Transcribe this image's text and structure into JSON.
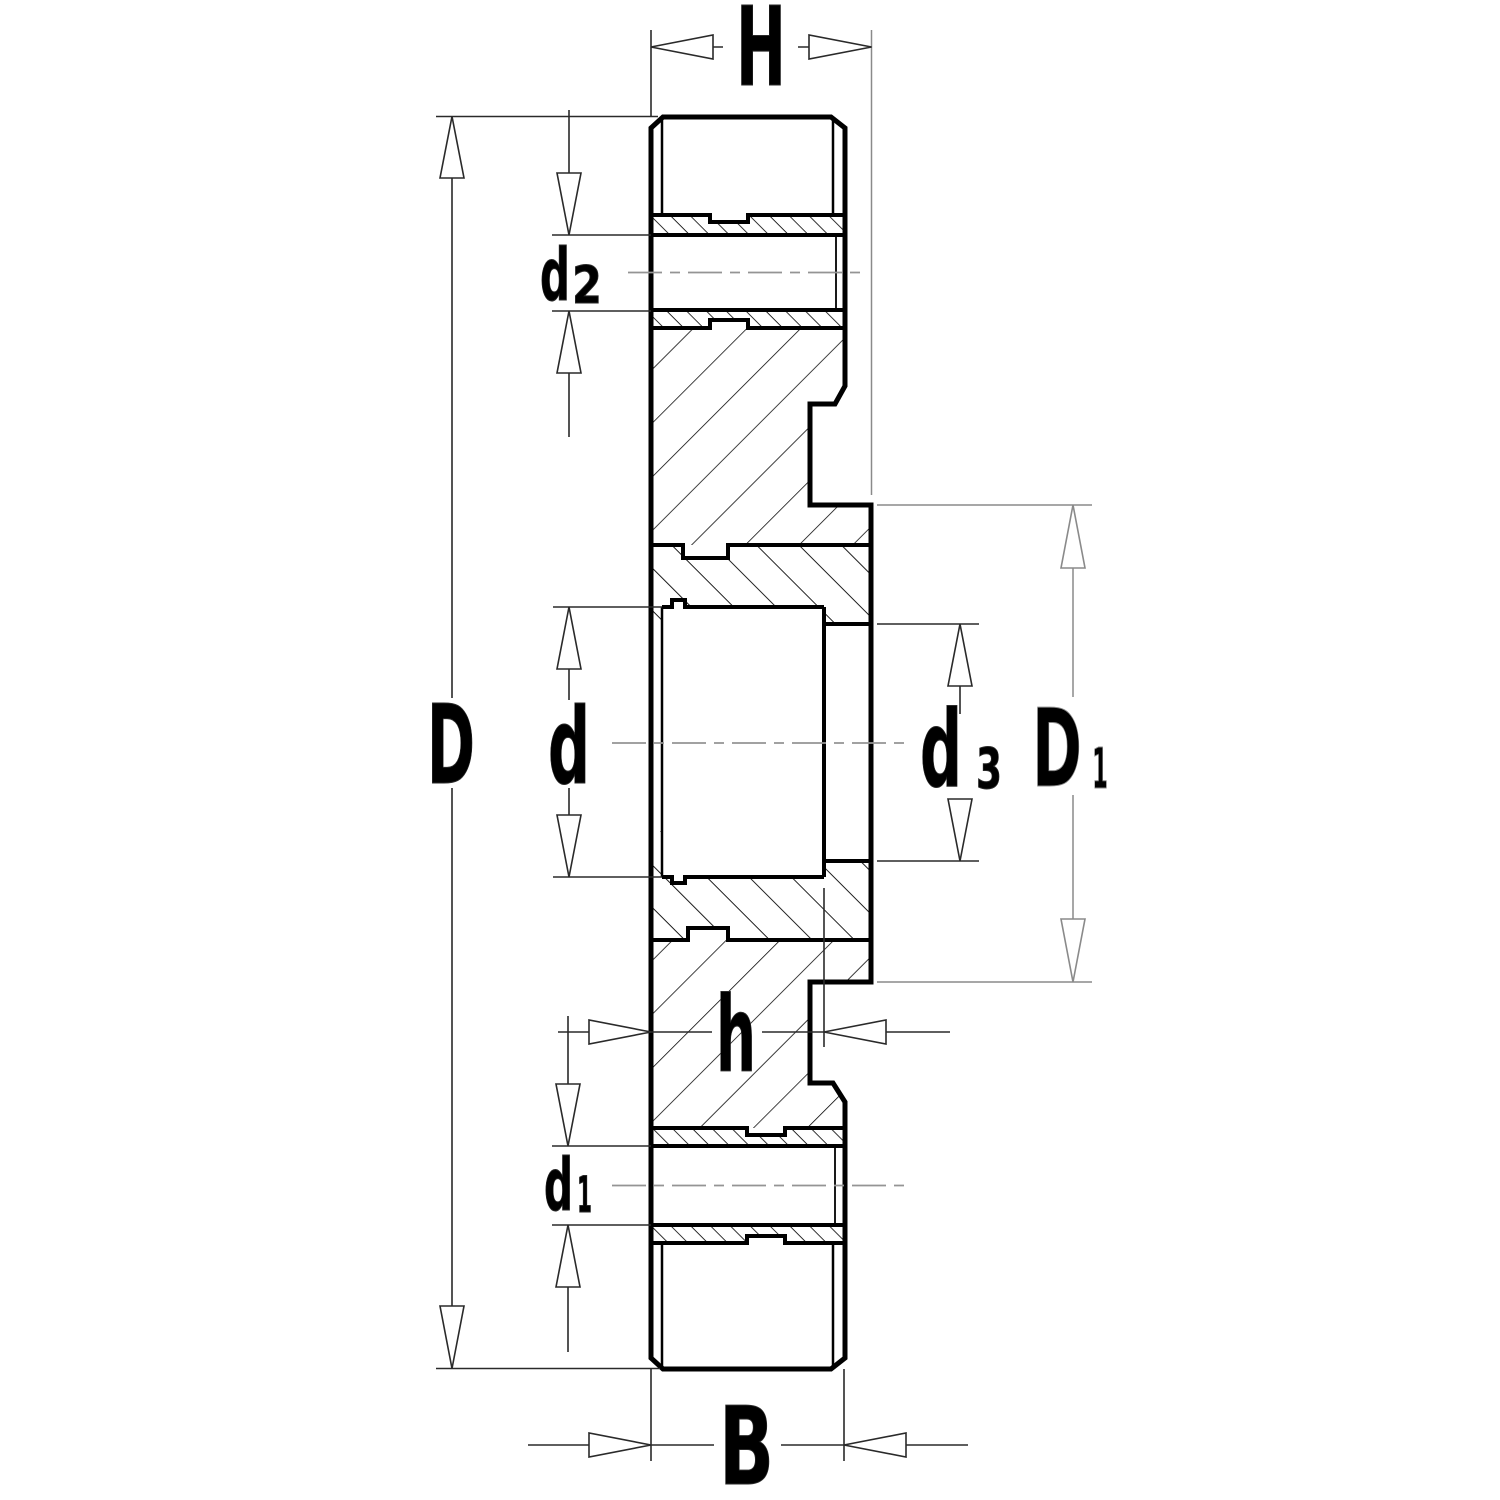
{
  "drawing": {
    "type": "technical-cross-section",
    "background": "#ffffff",
    "stroke_color": "#000000",
    "centerline_color": "#949494",
    "dim_color": "#2a2a2a",
    "dim_light_color": "#8a8a8a",
    "labels": {
      "H": {
        "main": "H"
      },
      "D": {
        "main": "D"
      },
      "d": {
        "main": "d"
      },
      "d2": {
        "main": "d",
        "sub": "2"
      },
      "d3": {
        "main": "d",
        "sub": "3"
      },
      "D1": {
        "main": "D",
        "sub": "1"
      },
      "h": {
        "main": "h"
      },
      "d1": {
        "main": "d",
        "sub": "1"
      },
      "B": {
        "main": "B"
      }
    }
  }
}
